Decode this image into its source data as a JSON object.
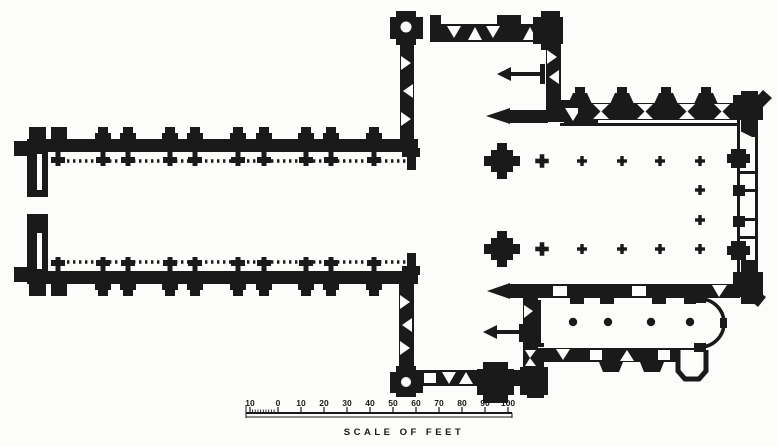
{
  "figure": {
    "type": "engraved ground plan of a cruciform church",
    "ink_color": "#1a1a1a",
    "paper_color": "#fcfcfa"
  },
  "plan": {
    "regions": [
      "nave",
      "northwest-stair-turret",
      "north-transept",
      "crossing",
      "choir",
      "east-window-wall",
      "south-transept",
      "southwest-stair-turret",
      "south-chapel",
      "apse",
      "sacristy-annexe"
    ],
    "choir_arcade_columns_per_row": 5,
    "choir_extra_columns": 2,
    "south_chapel_columns": 4,
    "altar_direction_marks": 4,
    "stair_turret_count": 2
  },
  "scale_bar": {
    "caption": "SCALE OF FEET",
    "labels": [
      "10",
      "0",
      "10",
      "20",
      "30",
      "40",
      "50",
      "60",
      "70",
      "80",
      "90",
      "100"
    ]
  }
}
